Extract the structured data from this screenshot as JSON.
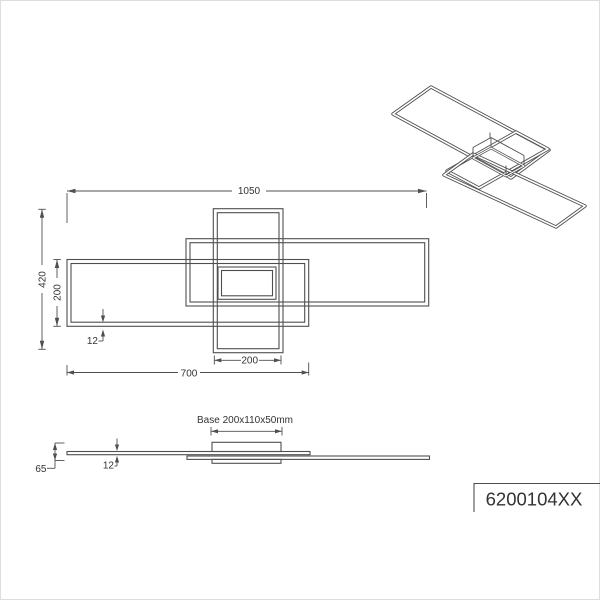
{
  "colors": {
    "line": "#4f4f4f",
    "text": "#333333",
    "background": "#ffffff",
    "border": "#dddddd"
  },
  "top_view": {
    "dim_overall_width": "1050",
    "dim_overall_depth": "420",
    "dim_frame_depth": "200",
    "dim_profile_width": "12",
    "dim_center_frame_width": "200",
    "dim_left_frame_width": "700"
  },
  "side_view": {
    "base_label": "Base 200x110x50mm",
    "dim_total_height": "65",
    "dim_profile_height": "12"
  },
  "article_number": "6200104XX"
}
